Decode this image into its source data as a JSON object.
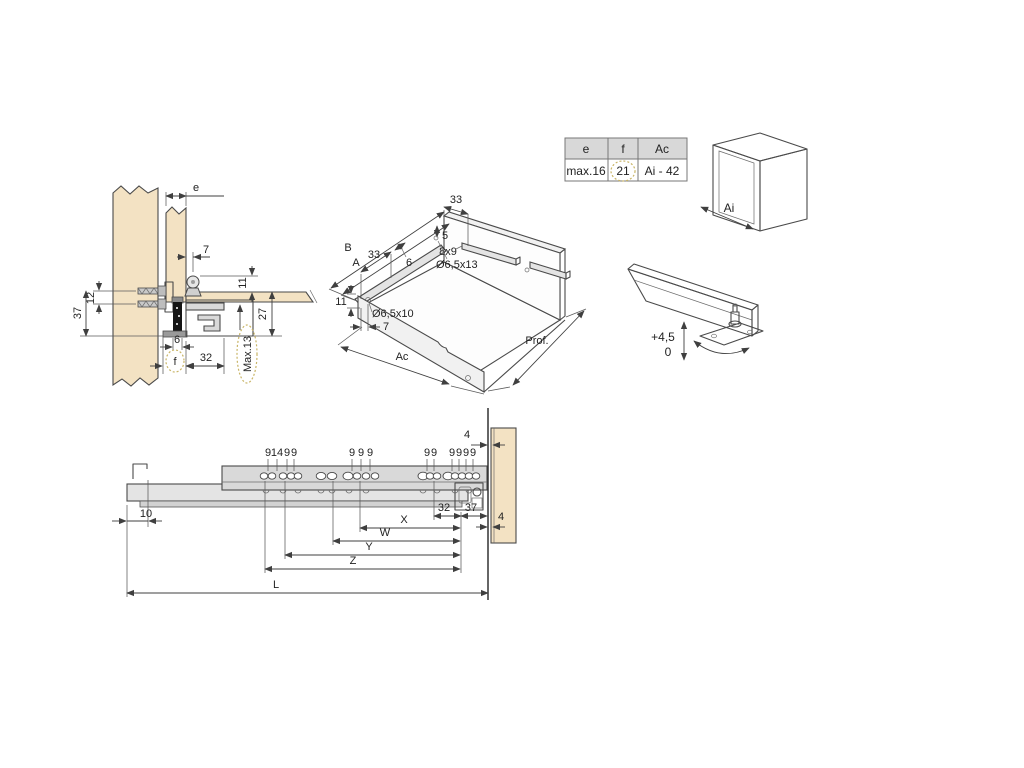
{
  "colors": {
    "background": "#ffffff",
    "wood": "#f3e2c3",
    "steel_gray": "#d9d9d9",
    "line": "#4a4a4a",
    "highlight_dotted": "#c9b567",
    "table_header_bg": "#d8d8d8"
  },
  "detail_view": {
    "dim_e": "e",
    "dim_7": "7",
    "dim_12": "12",
    "dim_37": "37",
    "dim_11": "11",
    "dim_27": "27",
    "dim_6": "6",
    "dim_f": "f",
    "dim_32": "32",
    "dim_max": "Max.13"
  },
  "drawer_3d": {
    "dim_33_top": "33",
    "dim_5": "5",
    "dim_slot": "8x9",
    "dim_hole_back": "Ø6,5x13",
    "dim_B": "B",
    "dim_A": "A",
    "dim_33": "33",
    "dim_6": "6",
    "dim_11": "11",
    "dim_hole_front": "Ø6,5x10",
    "dim_7": "7",
    "dim_Ac": "Ac",
    "dim_Prof": "Prof."
  },
  "spec_table": {
    "headers": [
      "e",
      "f",
      "Ac"
    ],
    "values": [
      "max.16",
      "21",
      "Ai - 42"
    ]
  },
  "cabinet_3d": {
    "dim_Ai": "Ai"
  },
  "rail_adjust": {
    "plus": "+4,5",
    "zero": "0"
  },
  "side_view": {
    "group1": [
      "9",
      "14",
      "9",
      "9"
    ],
    "group2": [
      "9",
      "9",
      "9"
    ],
    "group3": [
      "9",
      "9"
    ],
    "group4": [
      "9",
      "9",
      "9",
      "9"
    ],
    "dim_4_top": "4",
    "dim_10": "10",
    "dim_32": "32",
    "dim_37": "37",
    "dim_4_right": "4",
    "dim_X": "X",
    "dim_W": "W",
    "dim_Y": "Y",
    "dim_Z": "Z",
    "dim_L": "L"
  }
}
